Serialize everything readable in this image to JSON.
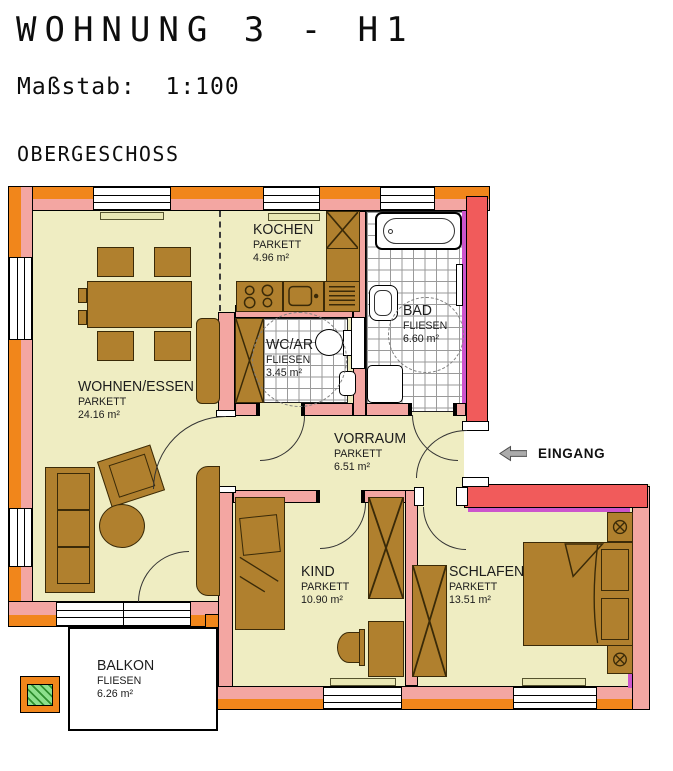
{
  "header": {
    "title": "WOHNUNG 3 - H1",
    "scale_label": "Maßstab:  1:100",
    "floor_label": "OBERGESCHOSS"
  },
  "rooms": [
    {
      "name": "WOHNEN/ESSEN",
      "floor": "PARKETT",
      "area": "24.16 m²"
    },
    {
      "name": "KOCHEN",
      "floor": "PARKETT",
      "area": "4.96 m²"
    },
    {
      "name": "BAD",
      "floor": "FLIESEN",
      "area": "6.60 m²"
    },
    {
      "name": "WC/AR",
      "floor": "FLIESEN",
      "area": "3.45 m²"
    },
    {
      "name": "VORRAUM",
      "floor": "PARKETT",
      "area": "6.51 m²"
    },
    {
      "name": "KIND",
      "floor": "PARKETT",
      "area": "10.90 m²"
    },
    {
      "name": "SCHLAFEN",
      "floor": "PARKETT",
      "area": "13.51 m²"
    },
    {
      "name": "BALKON",
      "floor": "FLIESEN",
      "area": "6.26 m²"
    }
  ],
  "entrance": {
    "label": "EINGANG"
  },
  "colors": {
    "exterior_insulation": "#F1861B",
    "wall_pink": "#F3A6A2",
    "wall_red": "#F15B5B",
    "wall_magenta_line": "#CC55CC",
    "floor_parquet": "#EFEDC2",
    "furniture_brown": "#B0802E",
    "drain_green": "#8CE08C"
  }
}
